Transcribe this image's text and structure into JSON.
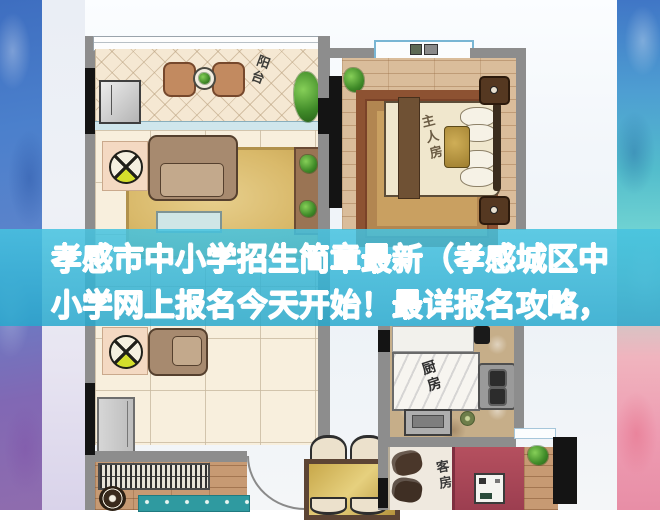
{
  "overlay": {
    "line1": "孝感市中小学招生简章最新（孝感城区中",
    "line2": "小学网上报名今天开始！最详报名攻略，",
    "text_color": "#ffffff",
    "band_color": "#2fb0d2"
  },
  "rooms": {
    "balcony_label": "阳台",
    "master_bedroom_label": "主人房",
    "kitchen_label": "厨房",
    "guest_room_label": "客房"
  },
  "colors": {
    "left_strip_top": "#3e6ec0",
    "left_strip_bottom": "#8f6cae",
    "right_strip_top": "#4076c6",
    "right_strip_teal": "#52bccc",
    "right_strip_pink": "#ee9cb2",
    "floor_tile": "#f8efdd",
    "wood_floor": "#dabd9b",
    "guest_bed": "#ad4558",
    "gold_rug": "#d9b96a"
  }
}
